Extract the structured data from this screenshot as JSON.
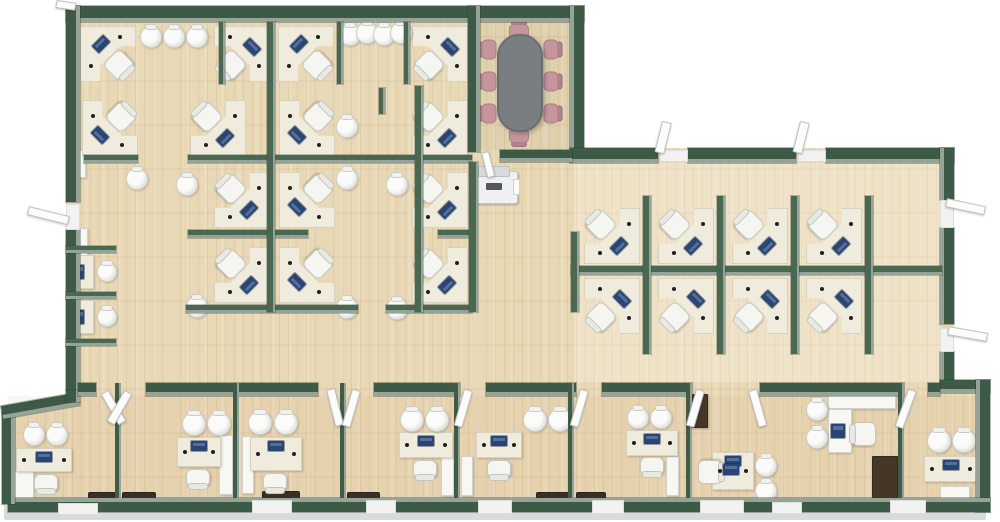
{
  "meta": {
    "description": "3D top-down office floor plan render, no visible text"
  },
  "palette": {
    "background": "#ffffff",
    "floor_wood": "#e9d8b6",
    "wall_green": "#3d5a47",
    "wall_face": "#96a399",
    "partition_green": "#4a6751",
    "desk_cream": "#efecdd",
    "chair_white": "#f5f5f2",
    "monitor_navy": "#2a4573",
    "conference_table_gray": "#7b7e81",
    "conference_chair_pink": "#c6959c",
    "mat_brown": "#3a2f25",
    "cabinet_brown": "#453728",
    "door_white": "#fcfcfb",
    "apron_gray": "#d8dadb"
  },
  "apron": {
    "x": 4,
    "y": 505,
    "w": 982,
    "h": 15
  },
  "tints": [
    {
      "x": 574,
      "y": 163,
      "w": 366,
      "h": 219,
      "c": "rgba(255,252,245,0.28)"
    },
    {
      "x": 8,
      "y": 396,
      "w": 980,
      "h": 102,
      "c": "rgba(205,150,100,0.09)"
    },
    {
      "x": 480,
      "y": 18,
      "w": 90,
      "h": 132,
      "c": "rgba(120,110,95,0.08)"
    }
  ],
  "walls": [
    {
      "x": 66,
      "y": 6,
      "w": 518,
      "h": 16,
      "f": "s"
    },
    {
      "x": 66,
      "y": 6,
      "w": 14,
      "h": 196,
      "f": "e"
    },
    {
      "x": 66,
      "y": 230,
      "w": 14,
      "h": 160,
      "f": "e"
    },
    {
      "x": 570,
      "y": 6,
      "w": 14,
      "h": 156,
      "f": "w"
    },
    {
      "x": 570,
      "y": 148,
      "w": 88,
      "h": 15,
      "f": "s"
    },
    {
      "x": 688,
      "y": 148,
      "w": 108,
      "h": 15,
      "f": "s"
    },
    {
      "x": 826,
      "y": 148,
      "w": 128,
      "h": 15,
      "f": "s"
    },
    {
      "x": 940,
      "y": 148,
      "w": 14,
      "h": 52,
      "f": "w"
    },
    {
      "x": 940,
      "y": 228,
      "w": 14,
      "h": 96,
      "f": "w"
    },
    {
      "x": 940,
      "y": 352,
      "w": 14,
      "h": 32,
      "f": "w"
    },
    {
      "x": 940,
      "y": 380,
      "w": 50,
      "h": 13,
      "f": "s"
    },
    {
      "x": 976,
      "y": 380,
      "w": 14,
      "h": 132,
      "f": "w"
    },
    {
      "x": 8,
      "y": 498,
      "w": 982,
      "h": 14,
      "f": "n"
    },
    {
      "x": 2,
      "y": 412,
      "w": 13,
      "h": 92,
      "f": "e"
    },
    {
      "x": 2,
      "y": 406,
      "w": 78,
      "h": 13,
      "f": "s",
      "rot": -10
    },
    {
      "x": 66,
      "y": 390,
      "w": 14,
      "h": 12,
      "f": "e"
    },
    {
      "x": 78,
      "y": 383,
      "w": 18,
      "h": 13,
      "f": "s"
    },
    {
      "x": 146,
      "y": 383,
      "w": 172,
      "h": 13,
      "f": "s"
    },
    {
      "x": 374,
      "y": 383,
      "w": 86,
      "h": 13,
      "f": "s"
    },
    {
      "x": 486,
      "y": 383,
      "w": 90,
      "h": 13,
      "f": "s"
    },
    {
      "x": 602,
      "y": 383,
      "w": 90,
      "h": 13,
      "f": "s"
    },
    {
      "x": 760,
      "y": 383,
      "w": 144,
      "h": 13,
      "f": "s"
    },
    {
      "x": 928,
      "y": 383,
      "w": 12,
      "h": 13,
      "f": "s"
    },
    {
      "x": 468,
      "y": 6,
      "w": 12,
      "h": 146,
      "f": "e"
    },
    {
      "x": 500,
      "y": 150,
      "w": 72,
      "h": 12,
      "f": "s"
    }
  ],
  "dividers": [
    {
      "x": 115,
      "y": 383,
      "w": 6,
      "h": 115
    },
    {
      "x": 233,
      "y": 383,
      "w": 6,
      "h": 115
    },
    {
      "x": 340,
      "y": 383,
      "w": 6,
      "h": 115
    },
    {
      "x": 454,
      "y": 383,
      "w": 6,
      "h": 115
    },
    {
      "x": 568,
      "y": 383,
      "w": 6,
      "h": 115
    },
    {
      "x": 686,
      "y": 383,
      "w": 6,
      "h": 115
    },
    {
      "x": 898,
      "y": 383,
      "w": 6,
      "h": 115
    }
  ],
  "partitions": [
    {
      "x": 84,
      "y": 155,
      "w": 54,
      "h": 8
    },
    {
      "x": 188,
      "y": 155,
      "w": 284,
      "h": 8
    },
    {
      "x": 188,
      "y": 230,
      "w": 120,
      "h": 8
    },
    {
      "x": 438,
      "y": 230,
      "w": 34,
      "h": 8
    },
    {
      "x": 186,
      "y": 305,
      "w": 172,
      "h": 8
    },
    {
      "x": 386,
      "y": 305,
      "w": 86,
      "h": 8
    },
    {
      "x": 267,
      "y": 22,
      "w": 8,
      "h": 290
    },
    {
      "x": 415,
      "y": 86,
      "w": 8,
      "h": 226
    },
    {
      "x": 219,
      "y": 22,
      "w": 6,
      "h": 62
    },
    {
      "x": 337,
      "y": 22,
      "w": 6,
      "h": 62
    },
    {
      "x": 404,
      "y": 22,
      "w": 6,
      "h": 62
    },
    {
      "x": 379,
      "y": 88,
      "w": 6,
      "h": 26
    },
    {
      "x": 66,
      "y": 246,
      "w": 50,
      "h": 7
    },
    {
      "x": 66,
      "y": 292,
      "w": 50,
      "h": 7
    },
    {
      "x": 66,
      "y": 339,
      "w": 50,
      "h": 7
    },
    {
      "x": 469,
      "y": 162,
      "w": 9,
      "h": 150
    },
    {
      "x": 571,
      "y": 266,
      "w": 371,
      "h": 9
    },
    {
      "x": 571,
      "y": 232,
      "w": 8,
      "h": 80
    },
    {
      "x": 643,
      "y": 196,
      "w": 8,
      "h": 158
    },
    {
      "x": 717,
      "y": 196,
      "w": 8,
      "h": 158
    },
    {
      "x": 791,
      "y": 196,
      "w": 8,
      "h": 158
    },
    {
      "x": 865,
      "y": 196,
      "w": 8,
      "h": 158
    }
  ],
  "workstations": [
    {
      "x": 80,
      "y": 26,
      "r": 0
    },
    {
      "x": 214,
      "y": 26,
      "r": 90
    },
    {
      "x": 278,
      "y": 26,
      "r": 0
    },
    {
      "x": 412,
      "y": 26,
      "r": 90
    },
    {
      "x": 82,
      "y": 100,
      "r": 270
    },
    {
      "x": 190,
      "y": 100,
      "r": 180
    },
    {
      "x": 279,
      "y": 100,
      "r": 270
    },
    {
      "x": 412,
      "y": 100,
      "r": 180
    },
    {
      "x": 214,
      "y": 172,
      "r": 180
    },
    {
      "x": 279,
      "y": 172,
      "r": 270
    },
    {
      "x": 412,
      "y": 172,
      "r": 180
    },
    {
      "x": 214,
      "y": 247,
      "r": 180
    },
    {
      "x": 279,
      "y": 247,
      "r": 270
    },
    {
      "x": 412,
      "y": 247,
      "r": 180
    },
    {
      "x": 584,
      "y": 208,
      "r": 180
    },
    {
      "x": 658,
      "y": 208,
      "r": 180
    },
    {
      "x": 732,
      "y": 208,
      "r": 180
    },
    {
      "x": 806,
      "y": 208,
      "r": 180
    },
    {
      "x": 584,
      "y": 278,
      "r": 90
    },
    {
      "x": 658,
      "y": 278,
      "r": 90
    },
    {
      "x": 732,
      "y": 278,
      "r": 90
    },
    {
      "x": 806,
      "y": 278,
      "r": 90
    }
  ],
  "booths": [
    {
      "x": 70,
      "y": 253
    },
    {
      "x": 70,
      "y": 298
    }
  ],
  "round_chairs": [
    {
      "x": 140,
      "y": 26,
      "d": 22
    },
    {
      "x": 163,
      "y": 26,
      "d": 22
    },
    {
      "x": 186,
      "y": 26,
      "d": 22
    },
    {
      "x": 339,
      "y": 24,
      "d": 22
    },
    {
      "x": 356,
      "y": 22,
      "d": 22
    },
    {
      "x": 373,
      "y": 24,
      "d": 22
    },
    {
      "x": 390,
      "y": 22,
      "d": 22
    },
    {
      "x": 126,
      "y": 168,
      "d": 22
    },
    {
      "x": 176,
      "y": 174,
      "d": 22
    },
    {
      "x": 336,
      "y": 116,
      "d": 22
    },
    {
      "x": 336,
      "y": 168,
      "d": 22
    },
    {
      "x": 386,
      "y": 174,
      "d": 22
    },
    {
      "x": 186,
      "y": 296,
      "d": 22
    },
    {
      "x": 336,
      "y": 297,
      "d": 22
    },
    {
      "x": 386,
      "y": 298,
      "d": 22
    },
    {
      "x": 23,
      "y": 424,
      "d": 22
    },
    {
      "x": 46,
      "y": 424,
      "d": 22
    },
    {
      "x": 182,
      "y": 412,
      "d": 24
    },
    {
      "x": 207,
      "y": 412,
      "d": 24
    },
    {
      "x": 248,
      "y": 411,
      "d": 24
    },
    {
      "x": 274,
      "y": 411,
      "d": 24
    },
    {
      "x": 400,
      "y": 408,
      "d": 24
    },
    {
      "x": 425,
      "y": 408,
      "d": 24
    },
    {
      "x": 523,
      "y": 408,
      "d": 24
    },
    {
      "x": 548,
      "y": 408,
      "d": 24
    },
    {
      "x": 627,
      "y": 407,
      "d": 22
    },
    {
      "x": 650,
      "y": 407,
      "d": 22
    },
    {
      "x": 755,
      "y": 455,
      "d": 22
    },
    {
      "x": 755,
      "y": 480,
      "d": 22
    },
    {
      "x": 806,
      "y": 399,
      "d": 22
    },
    {
      "x": 806,
      "y": 427,
      "d": 22
    },
    {
      "x": 927,
      "y": 429,
      "d": 24
    },
    {
      "x": 952,
      "y": 429,
      "d": 24
    }
  ],
  "office_desks": [
    {
      "x": 16,
      "y": 448,
      "w": 56,
      "h": 24,
      "cx": 34,
      "cy": 474
    },
    {
      "x": 177,
      "y": 437,
      "w": 44,
      "h": 30,
      "cx": 186,
      "cy": 469
    },
    {
      "x": 250,
      "y": 437,
      "w": 52,
      "h": 34,
      "cx": 263,
      "cy": 473
    },
    {
      "x": 399,
      "y": 432,
      "w": 54,
      "h": 26,
      "cx": 413,
      "cy": 460
    },
    {
      "x": 476,
      "y": 432,
      "w": 46,
      "h": 26,
      "cx": 487,
      "cy": 460
    },
    {
      "x": 626,
      "y": 430,
      "w": 52,
      "h": 26,
      "cx": 640,
      "cy": 457
    },
    {
      "x": 712,
      "y": 452,
      "w": 42,
      "h": 38
    },
    {
      "x": 924,
      "y": 456,
      "w": 54,
      "h": 26
    }
  ],
  "task_chairs": [
    {
      "x": 698,
      "y": 460,
      "r": -90
    },
    {
      "x": 852,
      "y": 422,
      "r": 90
    }
  ],
  "white_rects": [
    {
      "x": 14,
      "y": 470,
      "w": 20,
      "h": 38,
      "n": "desk-return"
    },
    {
      "x": 219,
      "y": 435,
      "w": 14,
      "h": 60,
      "n": "cabinet"
    },
    {
      "x": 242,
      "y": 436,
      "w": 12,
      "h": 58,
      "n": "cabinet"
    },
    {
      "x": 441,
      "y": 456,
      "w": 13,
      "h": 40,
      "n": "cabinet"
    },
    {
      "x": 461,
      "y": 456,
      "w": 12,
      "h": 40,
      "n": "cabinet"
    },
    {
      "x": 666,
      "y": 456,
      "w": 13,
      "h": 40,
      "n": "cabinet"
    },
    {
      "x": 828,
      "y": 393,
      "w": 68,
      "h": 16,
      "n": "l-desk-top"
    },
    {
      "x": 828,
      "y": 409,
      "w": 24,
      "h": 44,
      "n": "l-desk-arm"
    },
    {
      "x": 940,
      "y": 486,
      "w": 30,
      "h": 16,
      "n": "side-table"
    },
    {
      "x": 74,
      "y": 150,
      "w": 12,
      "h": 28,
      "n": "radiator"
    },
    {
      "x": 76,
      "y": 228,
      "w": 12,
      "h": 28,
      "n": "radiator"
    }
  ],
  "extra_monitors": [
    {
      "x": 831,
      "y": 424,
      "w": 14,
      "h": 14
    },
    {
      "x": 723,
      "y": 464,
      "w": 16,
      "h": 11
    }
  ],
  "brown_items": [
    {
      "x": 872,
      "y": 456,
      "w": 26,
      "h": 46,
      "n": "cabinet-dark"
    },
    {
      "x": 692,
      "y": 394,
      "w": 16,
      "h": 34,
      "n": "locker-dark"
    }
  ],
  "mats": [
    {
      "x": 88,
      "y": 492,
      "w": 28,
      "h": 12
    },
    {
      "x": 122,
      "y": 492,
      "w": 34,
      "h": 12
    },
    {
      "x": 262,
      "y": 491,
      "w": 38,
      "h": 12
    },
    {
      "x": 347,
      "y": 492,
      "w": 33,
      "h": 12
    },
    {
      "x": 536,
      "y": 492,
      "w": 33,
      "h": 12
    },
    {
      "x": 576,
      "y": 492,
      "w": 30,
      "h": 12
    }
  ],
  "doors": [
    {
      "x": 28,
      "y": 206,
      "w": 42,
      "h": 9,
      "r": 14
    },
    {
      "x": 56,
      "y": 0,
      "w": 20,
      "h": 8,
      "r": 8
    },
    {
      "x": 662,
      "y": 122,
      "w": 10,
      "h": 32,
      "r": 14
    },
    {
      "x": 800,
      "y": 122,
      "w": 10,
      "h": 32,
      "r": 14
    },
    {
      "x": 946,
      "y": 198,
      "w": 40,
      "h": 9,
      "r": 12
    },
    {
      "x": 948,
      "y": 326,
      "w": 40,
      "h": 9,
      "r": 10
    },
    {
      "x": 100,
      "y": 392,
      "w": 9,
      "h": 36,
      "r": -30
    },
    {
      "x": 124,
      "y": 392,
      "w": 9,
      "h": 36,
      "r": 30
    },
    {
      "x": 326,
      "y": 389,
      "w": 9,
      "h": 38,
      "r": -14
    },
    {
      "x": 352,
      "y": 390,
      "w": 9,
      "h": 38,
      "r": 16
    },
    {
      "x": 464,
      "y": 390,
      "w": 9,
      "h": 38,
      "r": 16
    },
    {
      "x": 580,
      "y": 390,
      "w": 9,
      "h": 38,
      "r": 16
    },
    {
      "x": 696,
      "y": 390,
      "w": 9,
      "h": 38,
      "r": 16
    },
    {
      "x": 748,
      "y": 390,
      "w": 9,
      "h": 38,
      "r": -16
    },
    {
      "x": 908,
      "y": 390,
      "w": 9,
      "h": 40,
      "r": 20
    },
    {
      "x": 481,
      "y": 152,
      "w": 8,
      "h": 26,
      "r": -14
    }
  ],
  "thresholds": [
    {
      "x": 66,
      "y": 204,
      "w": 14,
      "h": 26
    },
    {
      "x": 940,
      "y": 200,
      "w": 14,
      "h": 28
    },
    {
      "x": 940,
      "y": 328,
      "w": 14,
      "h": 24
    },
    {
      "x": 660,
      "y": 150,
      "w": 28,
      "h": 12
    },
    {
      "x": 798,
      "y": 150,
      "w": 28,
      "h": 12
    },
    {
      "x": 58,
      "y": 503,
      "w": 40,
      "h": 12
    },
    {
      "x": 252,
      "y": 500,
      "w": 40,
      "h": 14
    },
    {
      "x": 366,
      "y": 500,
      "w": 30,
      "h": 14
    },
    {
      "x": 478,
      "y": 500,
      "w": 34,
      "h": 14
    },
    {
      "x": 592,
      "y": 500,
      "w": 32,
      "h": 14
    },
    {
      "x": 700,
      "y": 500,
      "w": 44,
      "h": 14
    },
    {
      "x": 772,
      "y": 502,
      "w": 30,
      "h": 12
    },
    {
      "x": 890,
      "y": 500,
      "w": 36,
      "h": 14
    }
  ],
  "conference": {
    "table": {
      "x": 497,
      "y": 34,
      "w": 46,
      "h": 98
    },
    "tv": {
      "x": 500,
      "y": 7,
      "w": 34,
      "h": 8
    },
    "chairs": [
      {
        "x": 477,
        "y": 40,
        "r": -90
      },
      {
        "x": 477,
        "y": 72,
        "r": -90
      },
      {
        "x": 477,
        "y": 104,
        "r": -90
      },
      {
        "x": 543,
        "y": 40,
        "r": 90
      },
      {
        "x": 543,
        "y": 72,
        "r": 90
      },
      {
        "x": 543,
        "y": 104,
        "r": 90
      },
      {
        "x": 509,
        "y": 20,
        "r": 0
      },
      {
        "x": 509,
        "y": 128,
        "r": 180
      }
    ]
  },
  "copier": {
    "x": 470,
    "y": 166
  }
}
